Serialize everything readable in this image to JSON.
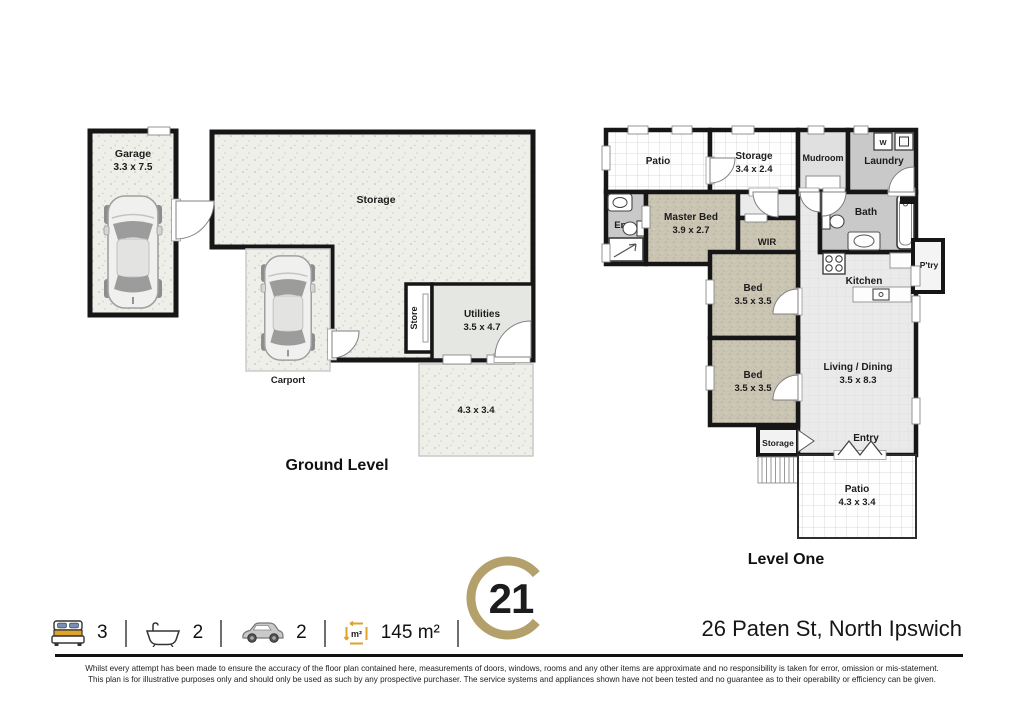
{
  "meta": {
    "address": "26 Paten St, North Ipswich",
    "brand_number": "21",
    "brand_color": "#b3a06a",
    "icon_accent_color": "#dfa32b"
  },
  "ground_level": {
    "title": "Ground Level",
    "rooms": {
      "garage": {
        "name": "Garage",
        "dims": "3.3 x 7.5"
      },
      "storage": {
        "name": "Storage"
      },
      "store": {
        "name": "Store"
      },
      "utilities": {
        "name": "Utilities",
        "dims": "3.5 x 4.7"
      },
      "open_area": {
        "dims": "4.3 x 3.4"
      },
      "carport": {
        "name": "Carport"
      }
    }
  },
  "level_one": {
    "title": "Level One",
    "rooms": {
      "patio_top": {
        "name": "Patio"
      },
      "storage_top": {
        "name": "Storage",
        "dims": "3.4 x 2.4"
      },
      "mudroom": {
        "name": "Mudroom"
      },
      "laundry": {
        "name": "Laundry",
        "washer_label": "W"
      },
      "ens": {
        "name": "Ens"
      },
      "master_bed": {
        "name": "Master Bed",
        "dims": "3.9 x 2.7"
      },
      "wir": {
        "name": "WIR"
      },
      "bath": {
        "name": "Bath"
      },
      "kitchen": {
        "name": "Kitchen"
      },
      "pantry": {
        "name": "P'try"
      },
      "bed1": {
        "name": "Bed",
        "dims": "3.5 x 3.5"
      },
      "bed2": {
        "name": "Bed",
        "dims": "3.5 x 3.5"
      },
      "living": {
        "name": "Living / Dining",
        "dims": "3.5 x 8.3"
      },
      "storage_small": {
        "name": "Storage"
      },
      "entry": {
        "name": "Entry"
      },
      "patio_bottom": {
        "name": "Patio",
        "dims": "4.3 x 3.4"
      }
    }
  },
  "summary": {
    "beds": "3",
    "baths": "2",
    "cars": "2",
    "area": "145 m²",
    "area_icon_label": "m²"
  },
  "disclaimer": {
    "line1": "Whilst every attempt has been made to ensure the accuracy of the floor plan contained here, measurements of doors, windows, rooms and any other items are approximate and no responsibility is taken for error, omission  or mis-statement.",
    "line2": "This plan is for illustrative purposes only and should only be used as such by any prospective purchaser. The service systems and appliances shown have not been tested and no guarantee as to their operability or efficiency can be given."
  }
}
